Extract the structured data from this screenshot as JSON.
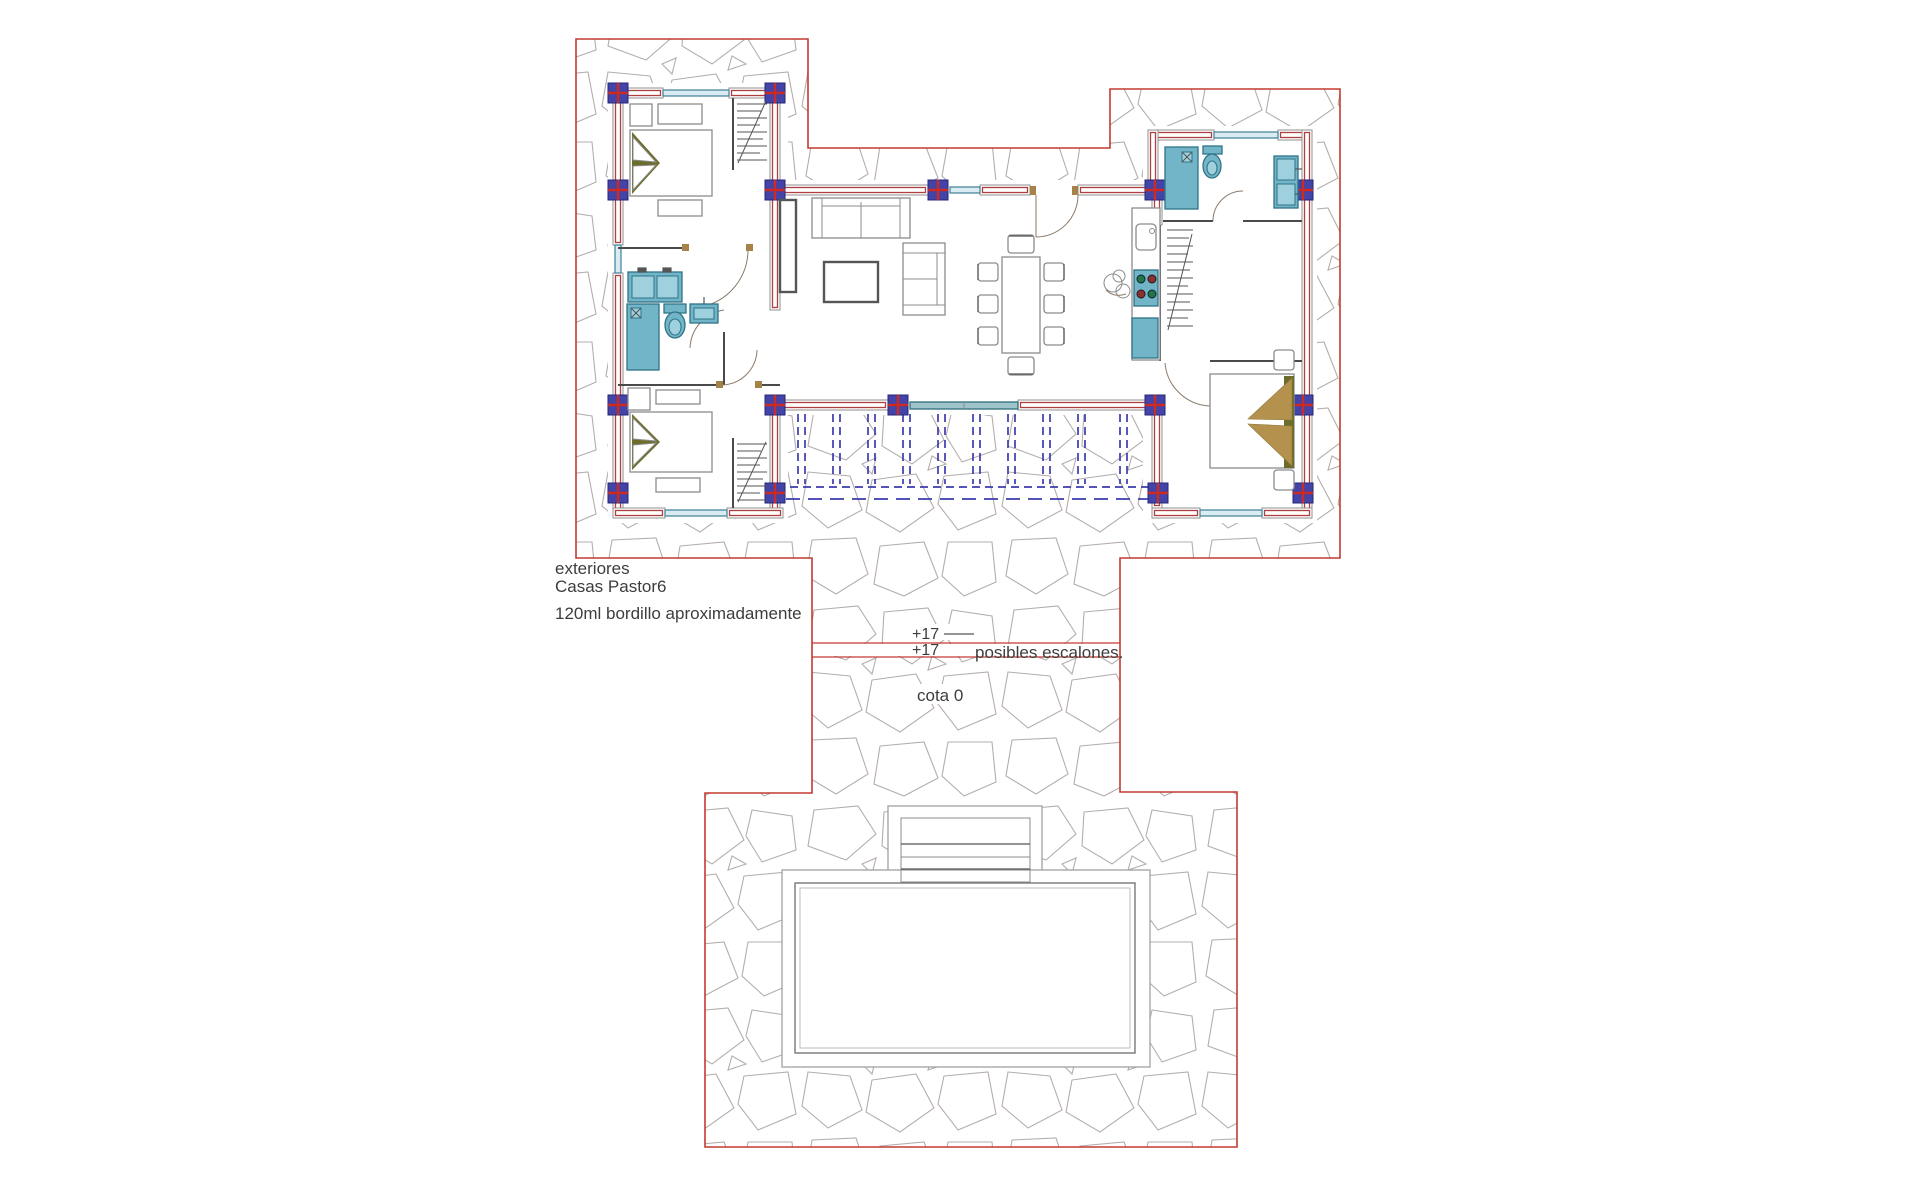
{
  "labels": {
    "exterior_line1": "exteriores",
    "exterior_line2": "Casas Pastor6",
    "curb_note": "120ml bordillo aproximadamente",
    "level_upper": "+17",
    "level_lower": "+17",
    "steps_note": "posibles escalones.",
    "datum_note": "cota 0"
  },
  "colors": {
    "boundary_red": "#c23a30",
    "wall_red": "#b04040",
    "column_navy": "#4343a8",
    "cross_red": "#cc2a22",
    "fixture_blue": "#72b4c8",
    "window_teal": "#3f7f95",
    "stone_gray": "#b5adad",
    "pergola_blue": "#3c3cae",
    "pillow_olive": "#6d6d2b",
    "pillow_tan": "#b5914e",
    "text_color": "#3d3d3d"
  }
}
